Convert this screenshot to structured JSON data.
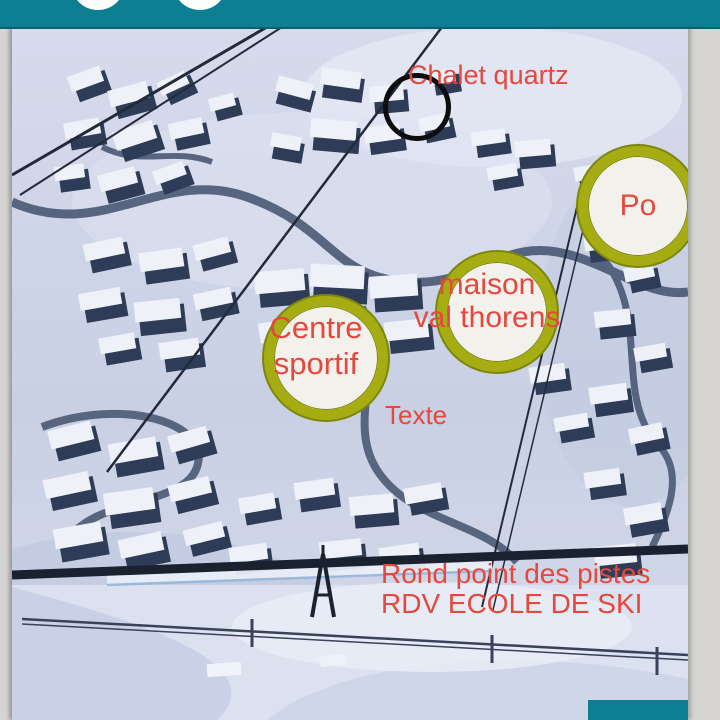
{
  "colors": {
    "teal": "#0d7f93",
    "teal-dark-edge": "#07606f",
    "frame-gray": "#d6d5d3",
    "marker-ring": "#a6ad12",
    "marker-ring-edge": "#7e860d",
    "marker-fill": "#f3f1ec",
    "label-red": "#e5483d",
    "annotation-black": "#0d0d0d"
  },
  "annotations": {
    "chalet_quartz": "Chalet quartz",
    "po": "Po",
    "maison": {
      "line1": "maison",
      "line2": "val thorens"
    },
    "centre": {
      "line1": "Centre",
      "line2": "sportif"
    },
    "texte": "Texte",
    "rond_point": {
      "line1": "Rond point des pistes",
      "line2": "RDV ECOLE DE SKI"
    }
  }
}
